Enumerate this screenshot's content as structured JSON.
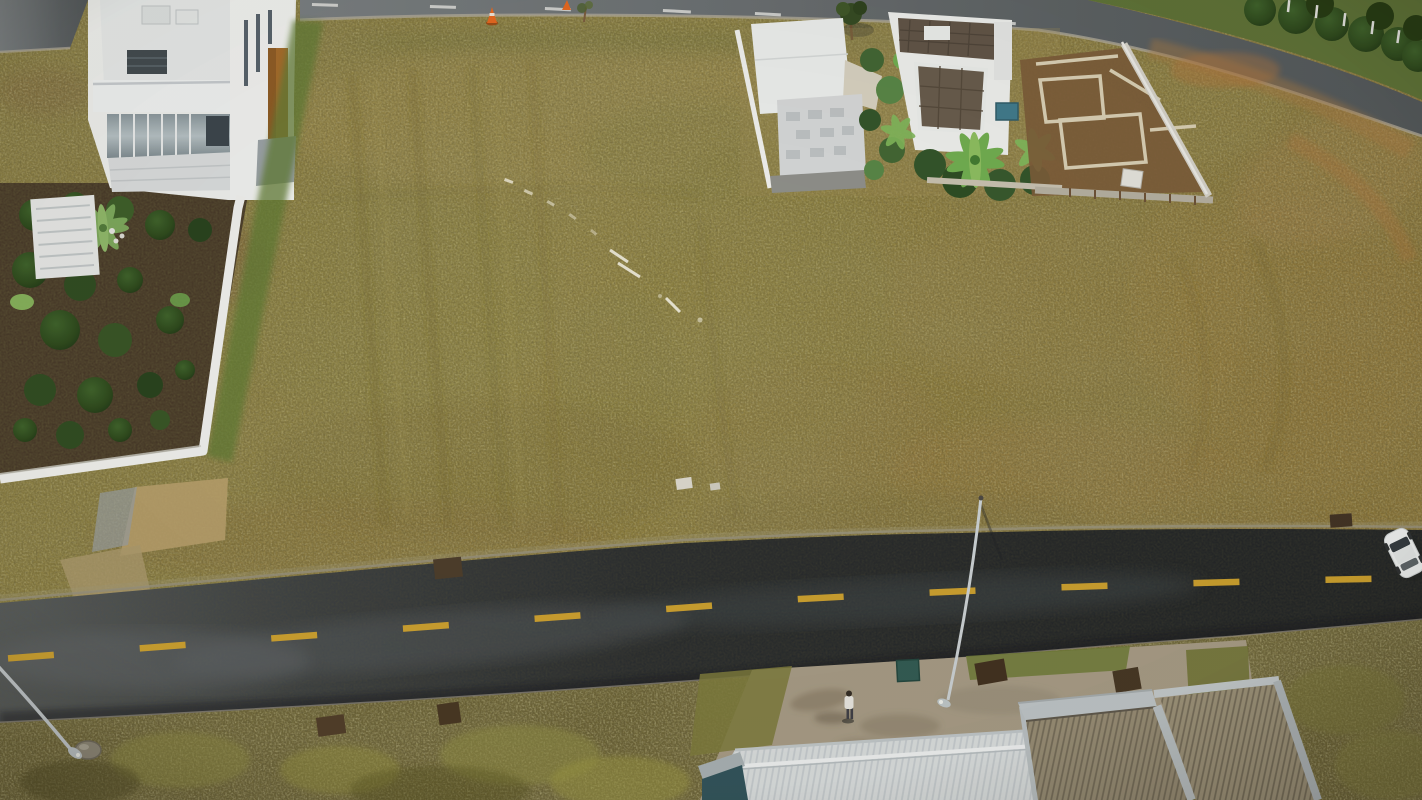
{
  "meta": {
    "type": "aerial-drone-photo",
    "subject": "Vacant residential land: two adjacent lots outlined in red beside a paved street in a gated development",
    "width": 1422,
    "height": 800
  },
  "annotation": {
    "outline_color": "#e81008",
    "lots": {
      "left_points": "643,204 897,198 963,533 685,538",
      "right_points": "897,198 1127,212 1231,527 963,533"
    }
  },
  "palette": {
    "field_base": "#8f813f",
    "field_light": "#a6924e",
    "field_brown": "#7d5a31",
    "field_orange": "#9c7a38",
    "shrub_dark": "#675d2c",
    "shrub_light": "#8f8c42",
    "asphalt_dark": "#202326",
    "asphalt_wet": "#565b5e",
    "lane_yellow": "#d7a62b",
    "top_road": "#63686b",
    "curb_light": "#a19a8a",
    "house_white": "#f1f2f0",
    "roof_white": "#dde1e2",
    "roof_tan": "#978c74",
    "roof_silver": "#bcc3c6",
    "roof_brown": "#5f5244",
    "stone_gray": "#d8dadb",
    "garden_soil": "#443525",
    "tree_green": "#2f501f",
    "palm_green": "#6fae4e",
    "wall_white": "#f4f4f1",
    "dirt_brown": "#7b5a36",
    "found_wall": "#dcd2b6",
    "pavement": "#a89c86",
    "teal_box": "#2f5a52",
    "teal_wedge": "#2e525a",
    "car_white": "#f1f3f3",
    "cone_orange": "#e8661c",
    "pole_gray": "#ced4d7",
    "water_tank": "#3e7a8c",
    "grass_verge": "#5f7a33"
  },
  "scene": {
    "objects": [
      "left-lot-outline",
      "right-lot-outline",
      "main-road",
      "top-road",
      "curved-road",
      "luxury-house",
      "construction-house-a",
      "construction-house-b",
      "foundation-layout",
      "street-light-center",
      "street-light-left",
      "white-car",
      "pedestrian",
      "traffic-cones",
      "bottom-rooftops",
      "drain-grates",
      "survey-markers"
    ],
    "road_markings": {
      "bottom_road_center_line": "yellow dashed",
      "top_road_center_line": "white dashed"
    }
  }
}
